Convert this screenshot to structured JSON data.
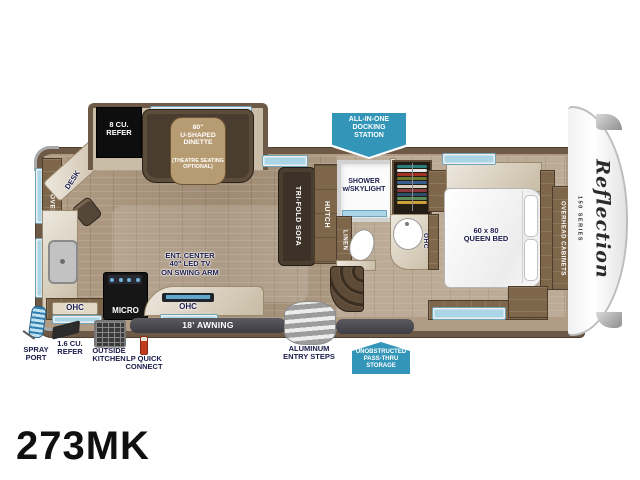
{
  "model": "273MK",
  "logo": {
    "script": "Reflection",
    "series": "150 SERIES"
  },
  "colors": {
    "badge_blue": "#3396b8",
    "label_navy": "#1b1b4a",
    "bar_gray": "#46464c",
    "wall_brown": "#6d5945"
  },
  "badges": {
    "docking": "ALL-IN-ONE\nDOCKING\nSTATION",
    "passthru": "UNOBSTRUCTED\nPASS-THRU\nSTORAGE"
  },
  "slideout": {
    "refer": "8 CU.\nREFER",
    "dinette": "80\"\nU-SHAPED\nDINETTE",
    "dinette_note": "(THEATRE SEATING\nOPTIONAL)"
  },
  "rear": {
    "overhead": "OVERHEAD CABINETS",
    "desk": "DESK"
  },
  "kitchen": {
    "ohc_left": "OHC",
    "micro": "MICRO",
    "ohc_right": "OHC",
    "ent_center": "ENT. CENTER\n40\" LED TV\nON SWING ARM"
  },
  "living": {
    "sofa": "TRI-FOLD SOFA",
    "hutch": "HUTCH"
  },
  "bath": {
    "shower": "SHOWER\nw/SKYLIGHT",
    "linen": "LINEN",
    "ohc": "OHC"
  },
  "bedroom": {
    "bed": "60 x 80\nQUEEN BED",
    "overhead": "OVERHEAD CABINETS"
  },
  "exterior": {
    "awning": "18' AWNING",
    "entry_steps": "ALUMINUM\nENTRY STEPS",
    "spray_port": "SPRAY\nPORT",
    "refer": "1.6 CU.\nREFER",
    "outside_kitchen": "OUTSIDE\nKITCHEN",
    "lp": "LP QUICK\nCONNECT"
  },
  "wardrobe_colors": [
    "#2e7d7d",
    "#e8e8e8",
    "#a33226",
    "#6b7a2e",
    "#3a5f8a",
    "#d8d0c0",
    "#8a3a3a",
    "#2e4f6b",
    "#5b8a5b",
    "#caa23a"
  ]
}
